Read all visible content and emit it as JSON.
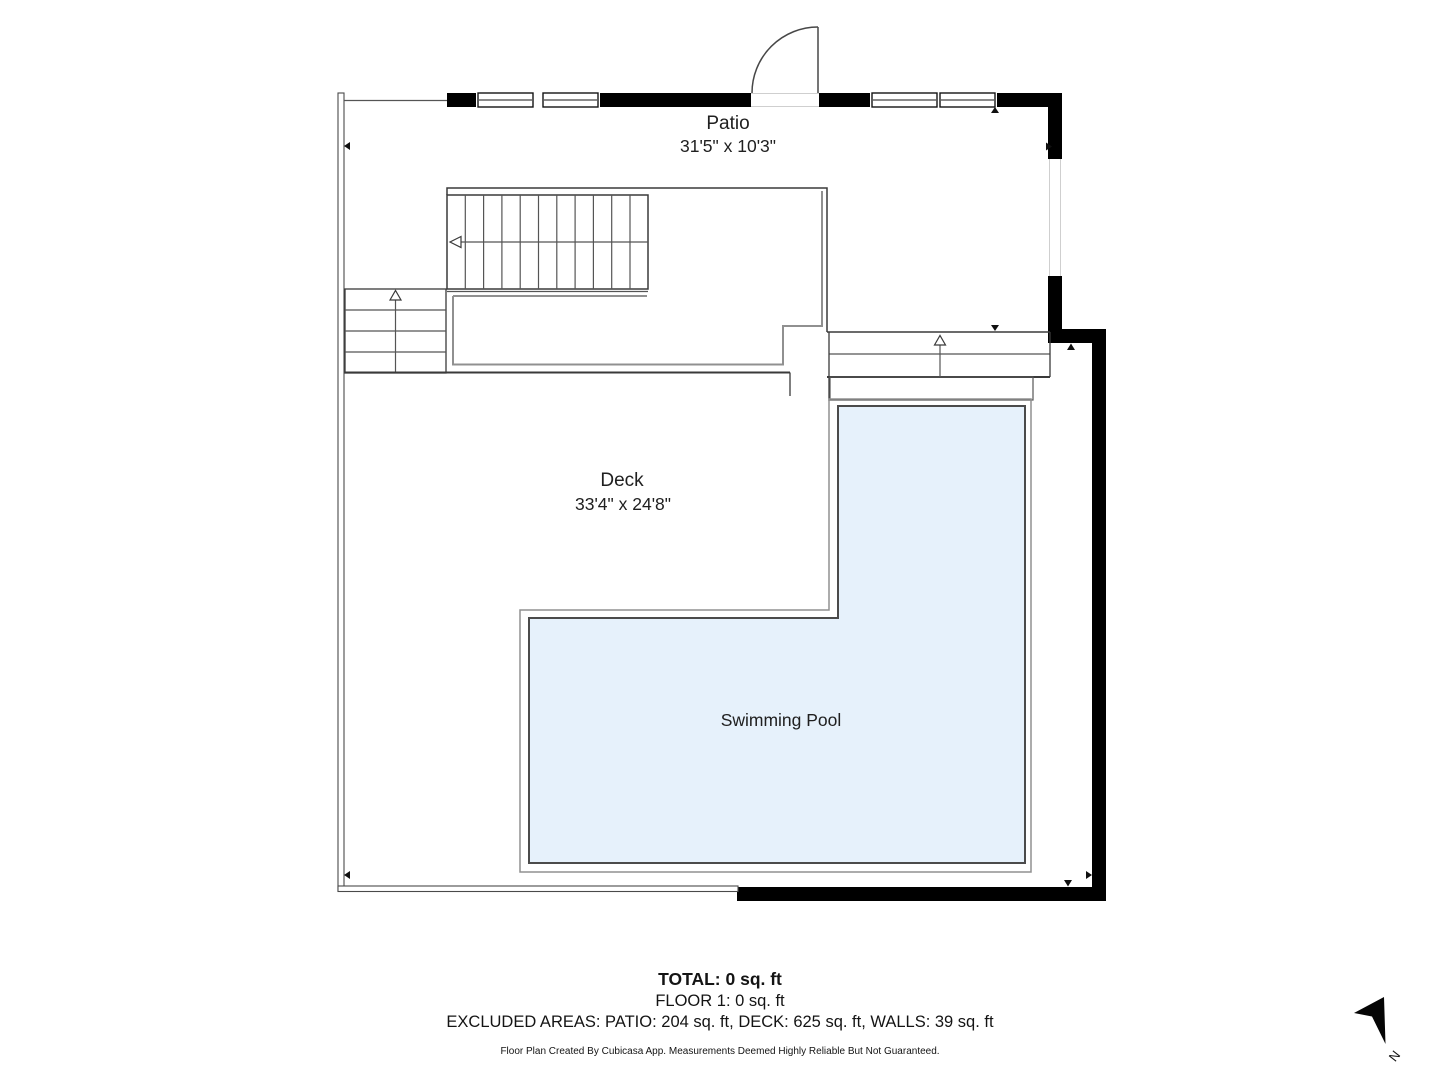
{
  "rooms": {
    "patio": {
      "label": "Patio",
      "dimensions": "31'5\" x 10'3\""
    },
    "deck": {
      "label": "Deck",
      "dimensions": "33'4\" x 24'8\""
    },
    "pool": {
      "label": "Swimming Pool"
    }
  },
  "summary": {
    "total": "TOTAL: 0 sq. ft",
    "floor": "FLOOR 1: 0 sq. ft",
    "excluded": "EXCLUDED AREAS: PATIO: 204 sq. ft, DECK: 625 sq. ft, WALLS: 39 sq. ft",
    "disclaimer": "Floor Plan Created By Cubicasa App. Measurements Deemed Highly Reliable But Not Guaranteed."
  },
  "compass": {
    "north_label": "N"
  },
  "colors": {
    "wall": "#000000",
    "line": "#3a3a3a",
    "gray_line": "#909090",
    "pool_fill": "#e6f1fb",
    "pool_border": "#4b4b4b",
    "text": "#202020"
  }
}
